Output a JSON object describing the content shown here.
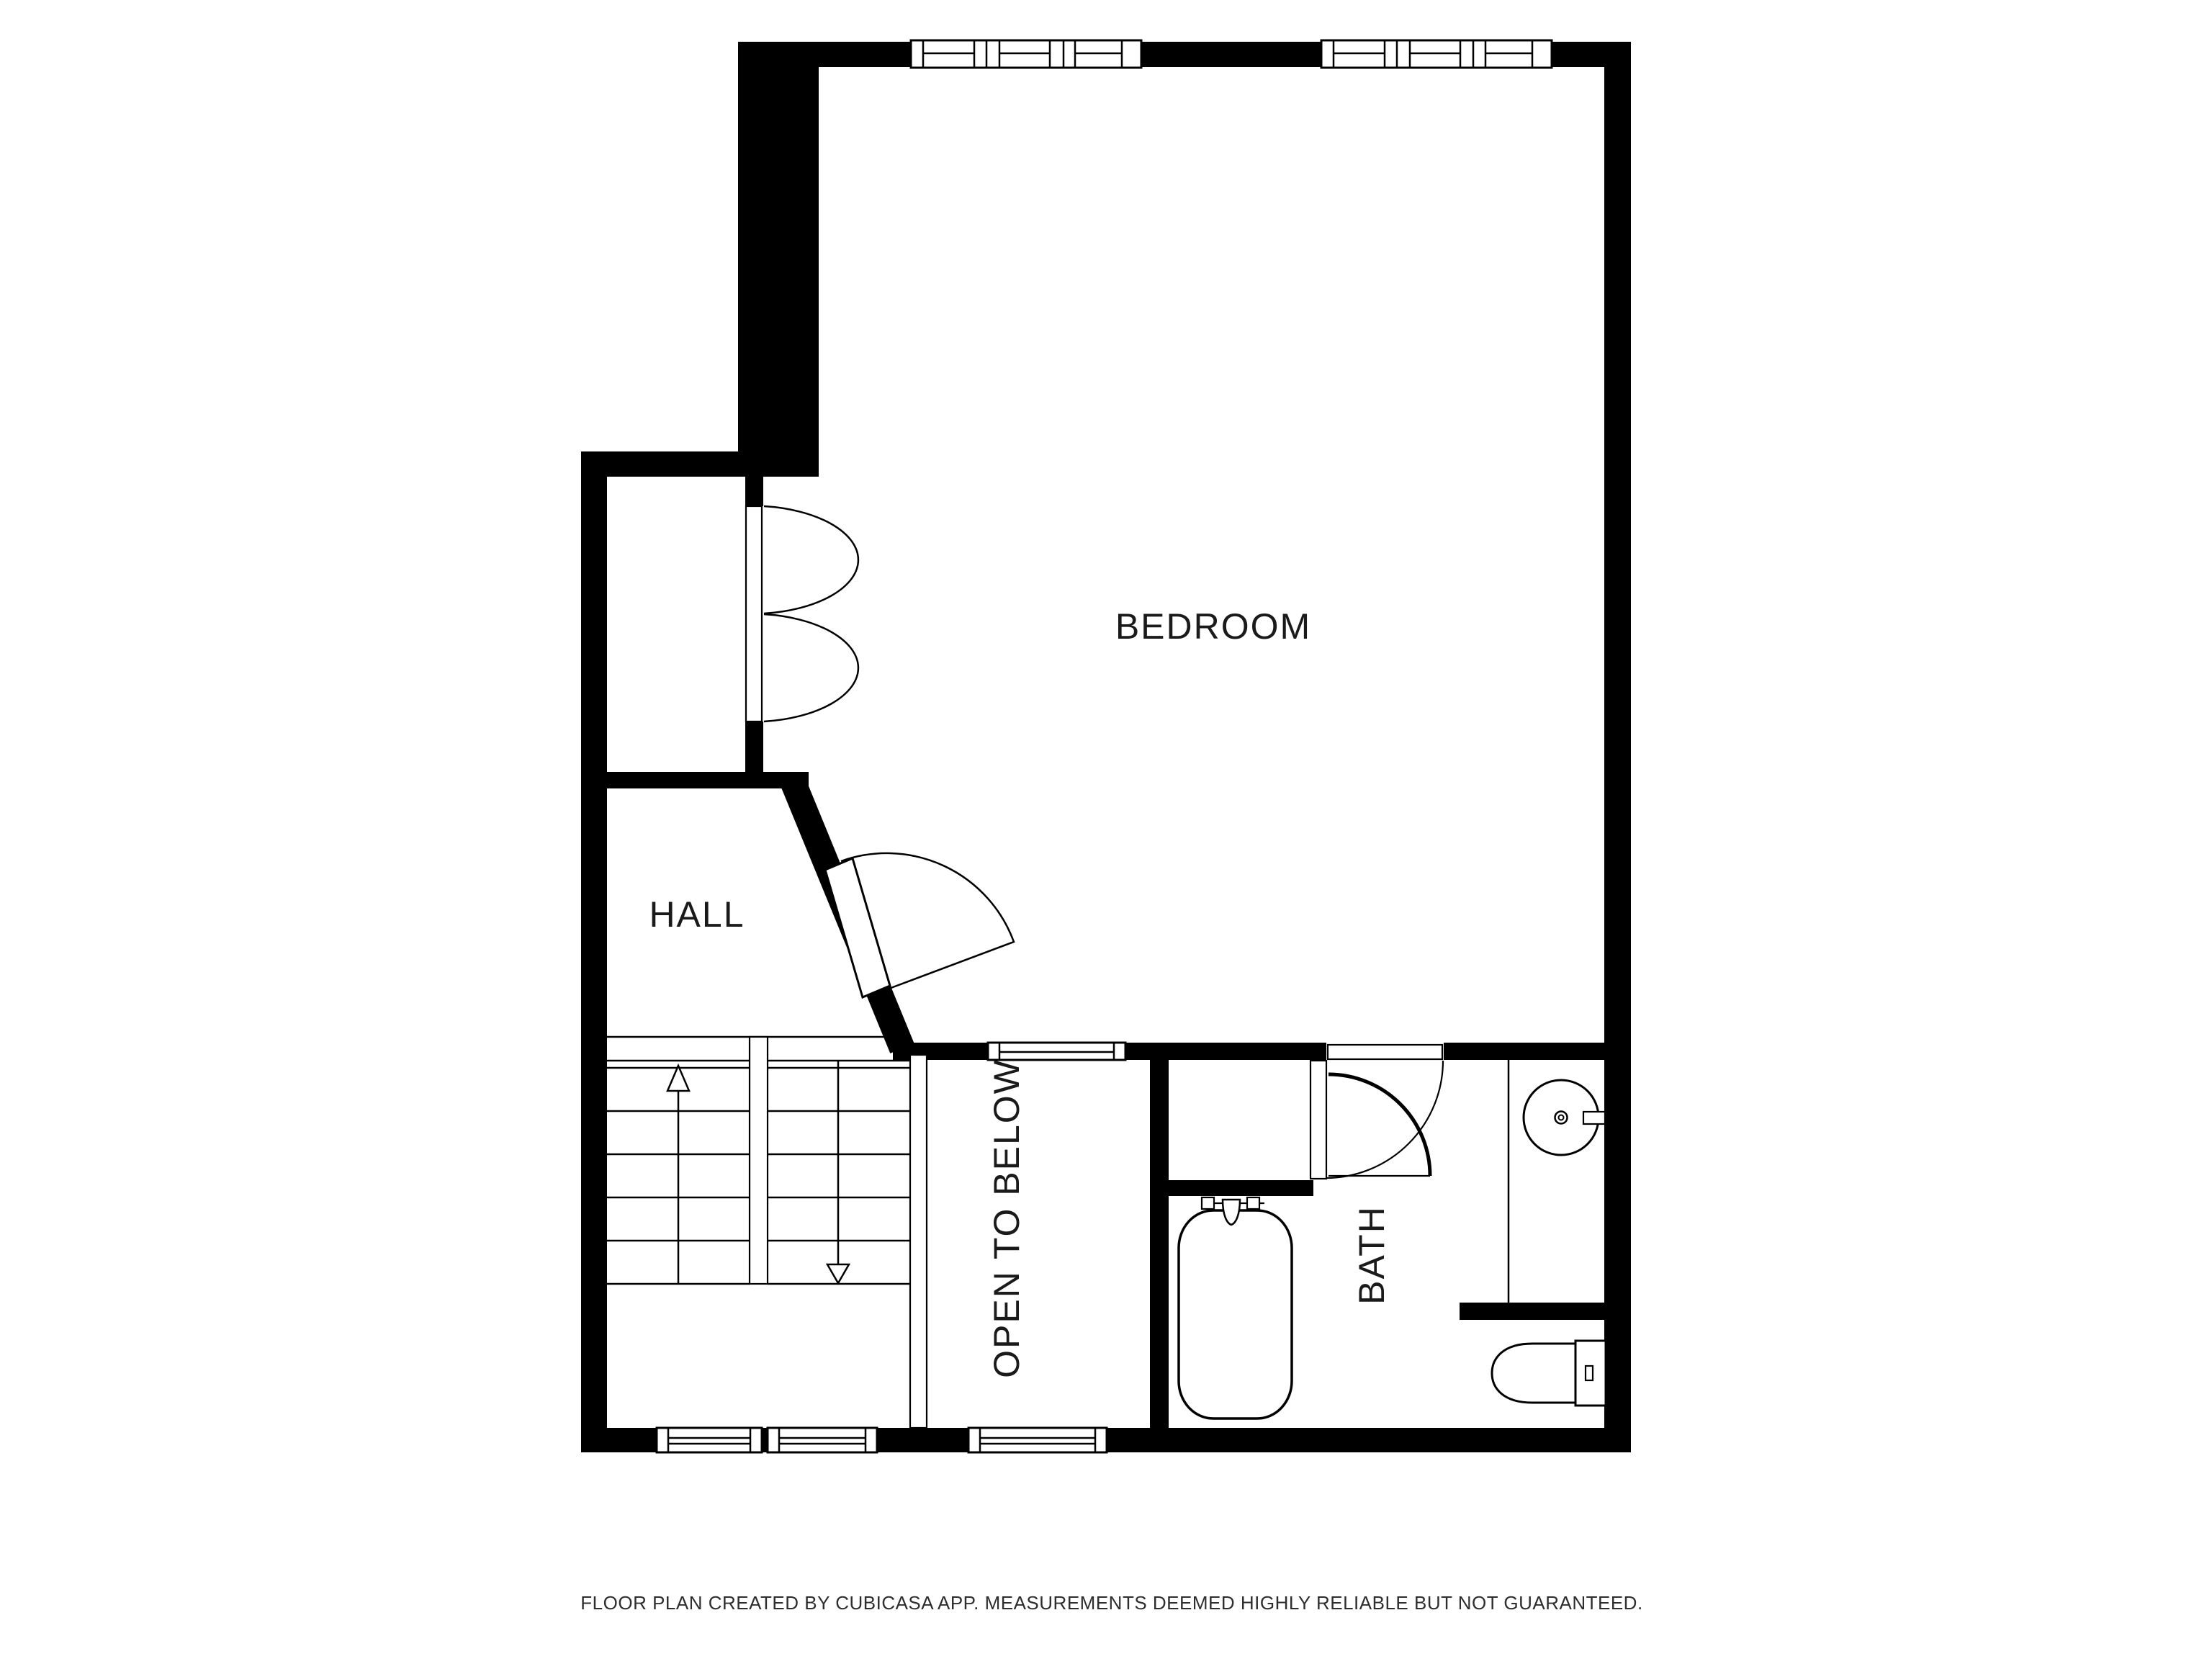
{
  "document": {
    "type": "floor-plan",
    "colors": {
      "background": "#ffffff",
      "walls": "#000000",
      "room_label_text": "#1a1a1a",
      "footer_text": "#2e2e2e"
    }
  },
  "rooms": [
    {
      "name": "bedroom",
      "label": "BEDROOM",
      "label_rotation_deg": 0
    },
    {
      "name": "hall",
      "label": "HALL",
      "label_rotation_deg": 0
    },
    {
      "name": "open-to-below",
      "label": "OPEN TO BELOW",
      "label_rotation_deg": -90
    },
    {
      "name": "bath",
      "label": "BATH",
      "label_rotation_deg": -90
    }
  ],
  "fixtures": [
    "bathtub",
    "bathtub-faucet",
    "round-sink-basin",
    "sink-faucet",
    "toilet",
    "double-swing-closet-door",
    "angled-hall-door",
    "bath-door",
    "staircase-up-flight",
    "staircase-down-flight"
  ],
  "windows": {
    "top_wall_groups": 2,
    "bottom_wall_count": 3,
    "interior_count": 1
  },
  "stairs": {
    "up_arrow": "up-flight-left",
    "down_arrow": "down-flight-right"
  },
  "footer": {
    "text": "FLOOR PLAN CREATED BY CUBICASA APP. MEASUREMENTS DEEMED HIGHLY RELIABLE BUT NOT GUARANTEED."
  }
}
